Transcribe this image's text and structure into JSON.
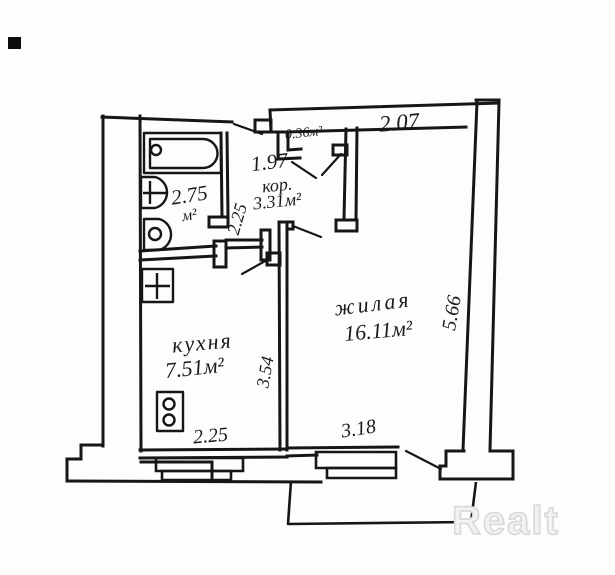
{
  "plan": {
    "rooms": {
      "closet": {
        "area": "0.36м²"
      },
      "corridor": {
        "name": "кор.",
        "area": "3.31м²"
      },
      "bathroom": {
        "area_value": "2.75",
        "area_unit": "м²"
      },
      "kitchen": {
        "name": "кухня",
        "area": "7.51м²"
      },
      "living": {
        "name": "жилая",
        "area": "16.11м²"
      }
    },
    "dimensions": {
      "living_top": "2.07",
      "corridor_top": "1.97",
      "bathroom_side": "2.25",
      "kitchen_side": "3.54",
      "living_side": "5.66",
      "kitchen_bottom": "2.25",
      "living_bottom": "3.18"
    },
    "watermark": "Realt",
    "line_color": "#161616",
    "watermark_color": "#d8d8d8"
  }
}
